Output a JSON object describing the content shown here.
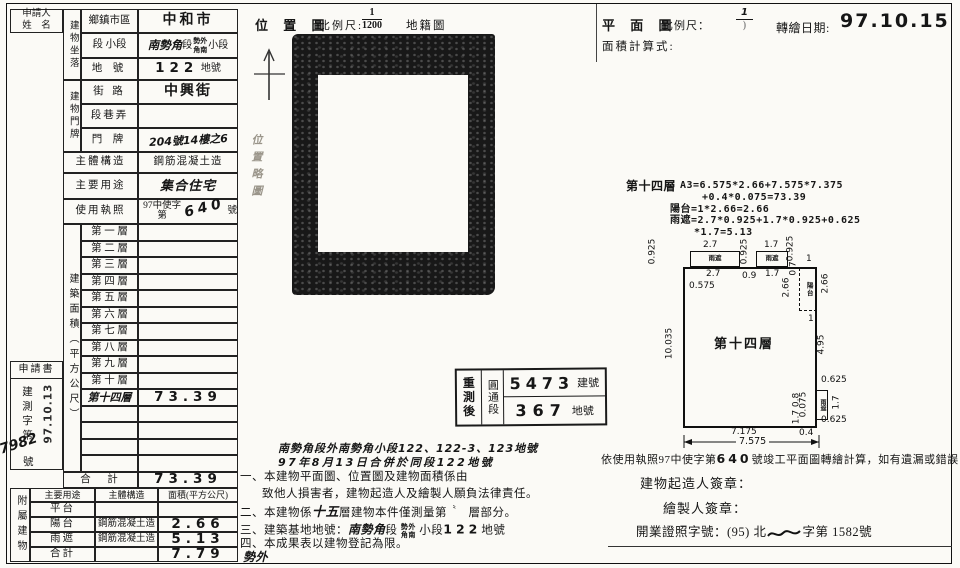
{
  "paper": {
    "background": "#fbfaf6",
    "ink": "#161616"
  },
  "left_form": {
    "applicant_line1": "申請人",
    "applicant_line2": "姓　名",
    "location_group": "建物坐落",
    "loc_row1_label": "鄉鎮市區",
    "loc_row1_value": "中和市",
    "loc_row2_label": "段 小段",
    "loc_row2_hand": "南勢角",
    "loc_row2_seg": "段",
    "loc_row2_stack_top": "勢外",
    "loc_row2_stack_bottom": "角南",
    "loc_row2_suffix": "小段",
    "loc_row3_label": "地 號",
    "loc_row3_value": "122",
    "loc_row3_unit": "地號",
    "door_group": "建物門牌",
    "door_row1_label": "街 路",
    "door_row1_value": "中興街",
    "door_row2_label": "段巷弄",
    "door_row2_value": "",
    "door_row3_label": "門 牌",
    "door_row3_value": "204號14樓之6",
    "structure_label": "主體構造",
    "structure_value": "鋼筋混凝土造",
    "usage_label": "主要用途",
    "usage_value": "集合住宅",
    "license_label": "使用執照",
    "license_prefix": "97中使字第",
    "license_number": "640",
    "license_suffix": "號",
    "area_group": "建築面積（平方公尺）",
    "floors": [
      {
        "label": "第 一 層",
        "value": ""
      },
      {
        "label": "第 二 層",
        "value": ""
      },
      {
        "label": "第 三 層",
        "value": ""
      },
      {
        "label": "第 四 層",
        "value": ""
      },
      {
        "label": "第 五 層",
        "value": ""
      },
      {
        "label": "第 六 層",
        "value": ""
      },
      {
        "label": "第 七 層",
        "value": ""
      },
      {
        "label": "第 八 層",
        "value": ""
      },
      {
        "label": "第 九 層",
        "value": ""
      },
      {
        "label": "第 十 層",
        "value": ""
      },
      {
        "label": "第十四層",
        "value": "73.39"
      },
      {
        "label": "",
        "value": ""
      },
      {
        "label": "",
        "value": ""
      },
      {
        "label": "",
        "value": ""
      },
      {
        "label": "",
        "value": ""
      }
    ],
    "total_label": "合　計",
    "total_value": "73.39",
    "annex_group": "附屬建物",
    "annex_headers": {
      "use": "主要用途",
      "structure": "主體構造",
      "area": "面積(平方公尺)"
    },
    "annex_rows": [
      {
        "use": "平台",
        "structure": "",
        "area": ""
      },
      {
        "use": "陽台",
        "structure": "鋼筋混凝土造",
        "area": "2.66"
      },
      {
        "use": "雨遮",
        "structure": "鋼筋混凝土造",
        "area": "5.13"
      },
      {
        "use": "合計",
        "structure": "",
        "area": "7.79"
      }
    ],
    "application_title": "申請書",
    "application_vertical": "建測字第",
    "application_unit": "號",
    "application_number": "7982",
    "application_date_stamp": "97.10.13"
  },
  "location_map": {
    "title": "位 置 圖",
    "scale_label": "比例尺:",
    "scale_numerator": "1",
    "scale_denominator": "1200",
    "map_type": "地籍圖",
    "faint_note": "位置略圖"
  },
  "resurvey_stamp": {
    "label": "重測後",
    "section": "圓通段",
    "building_number": "5473",
    "building_unit": "建號",
    "land_number": "367",
    "land_unit": "地號"
  },
  "notes": {
    "hand_line1": "南勢角段外南勢角小段122、122-3、123地號",
    "hand_line2": "97年8月13日合併於同段122地號",
    "item1": "一、本建物平面圖、位置圖及建物面積係由",
    "item1_cont": "致他人損害者，建物起造人及繪製人願負法律責任。",
    "item2_pre": "二、本建物係",
    "item2_hand": "十五",
    "item2_mid": "層建物本件僅測量第",
    "item2_mark": "〝",
    "item2_post": "層部分。",
    "item3_pre": "三、建築基地地號：",
    "item3_hand": "南勢角",
    "item3_seg": "段",
    "item3_stack_top": "勢外",
    "item3_stack_bottom": "角南",
    "item3_mid": "小段",
    "item3_num": "122",
    "item3_post": "地號",
    "item4": "四、本成果表以建物登記為限。",
    "bottom_hand": "勢外"
  },
  "plan": {
    "title": "平 面 圖",
    "scale_label": "比例尺：",
    "scale_numerator": "1",
    "scale_denominator": ")",
    "date_label": "轉繪日期:",
    "date_stamp": "97.10.15",
    "calc_label": "面積計算式:",
    "formula_title": "第十四層",
    "f1": "A3=6.575*2.66+7.575*7.375",
    "f2": "+0.4*0.075=73.39",
    "f3": "陽台=1*2.66=2.66",
    "f4": "雨遮=2.7*0.925+1.7*0.925+0.625",
    "f5": "*1.7=5.13",
    "room_label": "第十四層",
    "balcony_label": "陽台",
    "shelter_label": "雨遮",
    "dims": {
      "v0925_left": "0.925",
      "top_27_above": "2.7",
      "top_17_above": "1.7",
      "v0925_mid": "0.925",
      "v0925_right": "0.925",
      "top_1": "1",
      "top_27_below": "2.7",
      "gap_09": "0.9",
      "top_17_below": "1.7",
      "d_07": "0.7",
      "inset_0575": "0.575",
      "left_10035": "10.035",
      "balcony_266_inner": "2.66",
      "balcony_266_outer": "2.66",
      "balcony_1_below": "1",
      "right_495": "4.95",
      "shelter_0625_top": "0.625",
      "shelter_17_side": "1.7",
      "shelter_0625_bottom": "0.625",
      "inner_0075": "0.075",
      "inner_17_08": "1.7 0.8",
      "bottom_04": "0.4",
      "bottom_7175": "7.175",
      "bottom_7575": "7.575"
    }
  },
  "certification": {
    "line1_pre": "依使用執照97中使字第",
    "line1_number": "640",
    "line1_post": "號竣工平面圖轉繪計算，如有遺漏或錯誤",
    "sig_builder": "建物起造人簽章：",
    "sig_drafter": "繪製人簽章：",
    "license_pre": "開業證照字號：(95) 北",
    "license_post": "字第 1582號"
  }
}
